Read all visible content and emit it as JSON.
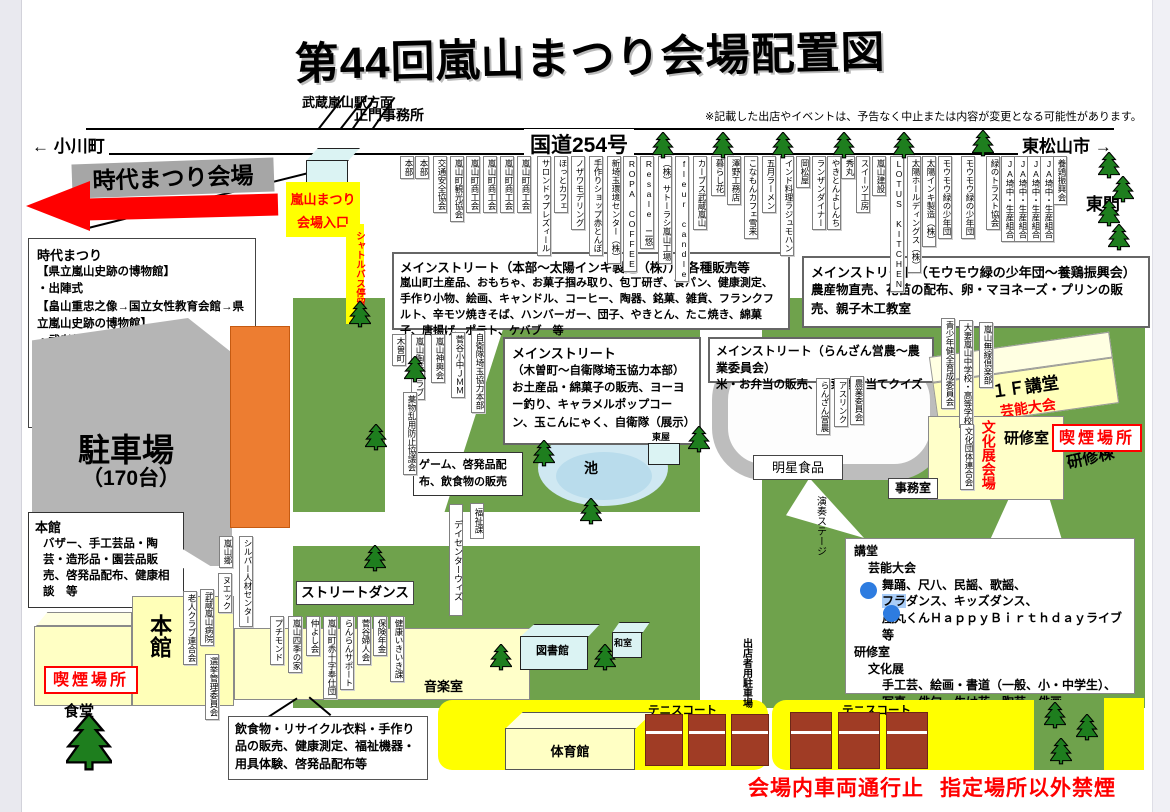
{
  "page": {
    "title": "第44回嵐山まつり会場配置図",
    "disclaimer": "※記載した出店やイベントは、予告なく中止または内容が変更となる可能性があります。"
  },
  "directions": {
    "station": "武蔵嵐山駅方面",
    "ogawamachi": "← 小川町",
    "higashimatsuyama": "東松山市 →",
    "east_gate": "東門",
    "route254": "国道254号",
    "main_gate_office": "正門事務所"
  },
  "jidai": {
    "banner": "時代まつり会場",
    "entrance1": "嵐山まつり",
    "entrance2": "会場入口",
    "shuttle": "シャトルバス停留所",
    "program_title": "時代まつり",
    "program_lines": [
      "【県立嵐山史跡の博物館】",
      "・出陣式",
      "【畠山重忠之像→国立女性教育会館→県立嵐山史跡の博物館】",
      "・武者行列",
      "【県立嵐山史跡の博物館】",
      "・火縄銃演武",
      "・和太鼓演奏",
      "・古里獅子舞"
    ]
  },
  "parking": {
    "label": "駐車場",
    "capacity": "（170台）"
  },
  "top_stalls": [
    "本部",
    "本部",
    "交通安全協会",
    "嵐山町観光協会",
    "嵐山町商工会",
    "嵐山町商工会",
    "嵐山町商工会",
    "嵐山町商工会",
    "サロンドゥプレズィール",
    "ほっとカフェ",
    "ノザワモデリング",
    "手作りショップ赤とんぼ",
    "新埼玉環境センター（株）",
    "ROPA COFFEE",
    "Resale 二悠",
    "（株）サトーラシ嵐山工場",
    "fleur candle",
    "カーブス武蔵嵐山",
    "暮らし花",
    "澤野工務店",
    "こなもんカフェ雪来",
    "五月ラーメン",
    "インド料理ラジュモハン",
    "岡松屋",
    "ランザンダイナー",
    "やきとんよしんち",
    "秀丸",
    "スイーツ工房",
    "嵐山建設",
    "LOTUS KITCHEN",
    "太陽ホールディングス（株）",
    "太陽インキ製造（株）",
    "モウモウ緑の少年団",
    "モウモウ緑の少年団",
    "緑のトラスト協会",
    "JA埼中・生産組合",
    "JA埼中・生産組合",
    "JA埼中・生産組合",
    "JA埼中・生産組合",
    "養鶏振興会"
  ],
  "street_stalls": [
    "木曽町",
    "嵐山陶芸クラブ",
    "嵐山神輿会",
    "菅谷小中ＪＭＭ",
    "自衛隊埼玉協力本部",
    "薬物乱用防止協議会"
  ],
  "left_labels": [
    "嵐山郷",
    "シルバー人材センター",
    "ヌエック",
    "武蔵嵐山病院",
    "老人クラブ連合会",
    "選挙管理委員会"
  ],
  "community_labels": [
    "プチモンド",
    "嵐山四季の家",
    "仲よし会",
    "嵐山町赤十字奉仕団",
    "らんらんサポート",
    "菅谷婦人会",
    "保険年金",
    "健康いきいき課"
  ],
  "right_labels": [
    "青少年健全育成委員会",
    "大妻嵐山中学校・高等学校",
    "文化団体連合会",
    "嵐山無線倶楽部"
  ],
  "track_labels": [
    "らんざん営農",
    "アスリンク",
    "農業委員会"
  ],
  "streets": {
    "m1_title": "メインストリート（本部～太陽インキ製造（株））　各種販売等",
    "m1_body": "嵐山町土産品、おもちゃ、お菓子掴み取り、包丁研ぎ、食パン、健康測定、手作り小物、絵画、キャンドル、コーヒー、陶器、銘菓、雑貨、フランクフルト、辛モツ焼きそば、ハンバーガー、団子、やきとん、たこ焼き、綿菓子、唐揚げ、ポテト、ケバブ　等",
    "m2_title": "メインストリート（モウモウ緑の少年団～養鶏振興会）",
    "m2_body": "農産物直売、花苗の配布、卵・マヨネーズ・プリンの販売、親子木工教室",
    "m3_title": "メインストリート",
    "m3_subtitle": "（木曽町～自衛隊埼玉協力本部）",
    "m3_body": "お土産品・綿菓子の販売、ヨーヨー釣り、キャラメルポップコーン、玉こんにゃく、自衛隊（展示）",
    "m4_title": "メインストリート（らんざん営農～農業委員会）",
    "m4_body": "米・お弁当の販売、野菜重さ当てクイズ"
  },
  "bubbles": {
    "game": "ゲーム、啓発品配布、飲食物の販売",
    "honkan_title": "本館",
    "honkan_body": "バザー、手工芸品・陶芸・造形品・園芸品販売、啓発品配布、健康相談　等",
    "inshoku": "飲食物・リサイクル衣料・手作り品の販売、健康測定、福祉機器・用具体験、啓発品配布等"
  },
  "hall": {
    "lines": [
      {
        "i": 0,
        "t": "講堂"
      },
      {
        "i": 1,
        "t": "芸能大会"
      },
      {
        "i": 2,
        "t": "舞踊、尺八、民謡、歌謡、"
      },
      {
        "i": 2,
        "hl": "フラ",
        "t": "ダンス、キッズダンス、"
      },
      {
        "i": 2,
        "t": "嵐丸くんＨａｐｐｙＢｉｒｔｈｄａｙライブ　等"
      },
      {
        "i": 0,
        "t": "研修室"
      },
      {
        "i": 1,
        "t": "文化展"
      },
      {
        "i": 2,
        "t": "手工芸、絵画・書道（一般、小・中学生）、"
      },
      {
        "i": 2,
        "t": "写真、俳句、生け花、陶芸、俳画"
      }
    ]
  },
  "facilities": {
    "honkan_big": "本館",
    "shokudo": "食堂",
    "smoking_left": "喫煙場所",
    "smoking_right": "喫煙場所",
    "street_dance": "ストリートダンス",
    "ongakushitsu": "音楽室",
    "library": "図書館",
    "washitsu": "和室",
    "pond": "池",
    "azumaya": "東屋",
    "fukushika": "福祉課",
    "daycenter": "デイセンターウィズ",
    "meisei": "明星食品",
    "stage": "演奏ステージ",
    "jimushitsu": "事務室",
    "kodo_1f": "１Ｆ講堂",
    "geino": "芸能大会",
    "kenshushitsu": "研修室",
    "kenshuto": "研修棟",
    "bunkaten": "文化展会場",
    "taiikukan": "体育館",
    "tennis1": "テニスコート",
    "tennis2": "テニスコート",
    "shutten_parking": "出店者用駐車場"
  },
  "notices": {
    "no_vehicles": "会場内車両通行止",
    "no_smoking": "指定場所以外禁煙"
  },
  "colors": {
    "green": "#6fa24c",
    "tree": "#1e7e1e",
    "yellow": "#ffff00",
    "building_yellow": "#ffffc4",
    "orange": "#ed7d31",
    "red": "#ff0000",
    "gray_banner": "#a6a6a6",
    "parking_gray": "#b5b5b5",
    "pond_blue": "#cfe8f2",
    "selection_blue": "#2e7ce0"
  }
}
